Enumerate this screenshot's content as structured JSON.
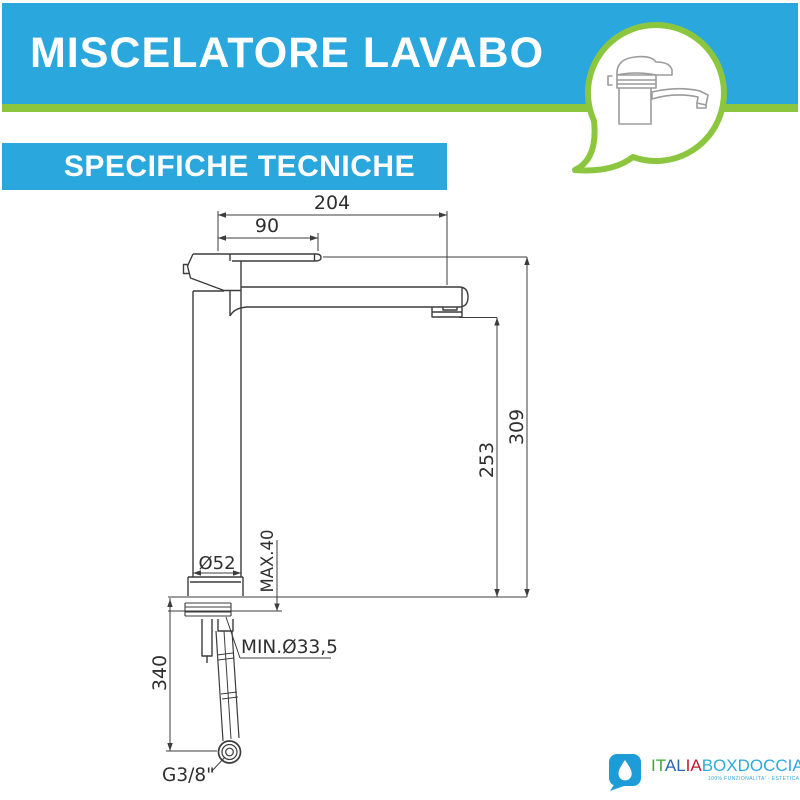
{
  "header": {
    "title": "MISCELATORE LAVABO"
  },
  "section": {
    "title": "SPECIFICHE TECNICHE"
  },
  "colors": {
    "banner_blue": "#2aa7dc",
    "accent_green": "#8cc63f",
    "drawing_line": "#3c3c3c",
    "logo_blue": "#2fa9de",
    "logo_green": "#3aaa35",
    "logo_dark_blue": "#2b66b1",
    "logo_red": "#be1e2d"
  },
  "drawing": {
    "dims": {
      "reach_total": "204",
      "reach_handle": "90",
      "height_total": "309",
      "height_spout": "253",
      "base_diameter": "Ø52",
      "max_deck_thickness": "MAX.40",
      "min_hole_diameter": "MIN.Ø33,5",
      "hose_length": "340",
      "thread": "G3/8\""
    }
  },
  "logo": {
    "italia_green": "IT",
    "italia_blue": "AL",
    "italia_red": "IA",
    "boxdoccia": "BOXDOCCIA",
    "tagline": "100% FUNZIONALITA' - ESTETICA - PRATICITA'"
  }
}
